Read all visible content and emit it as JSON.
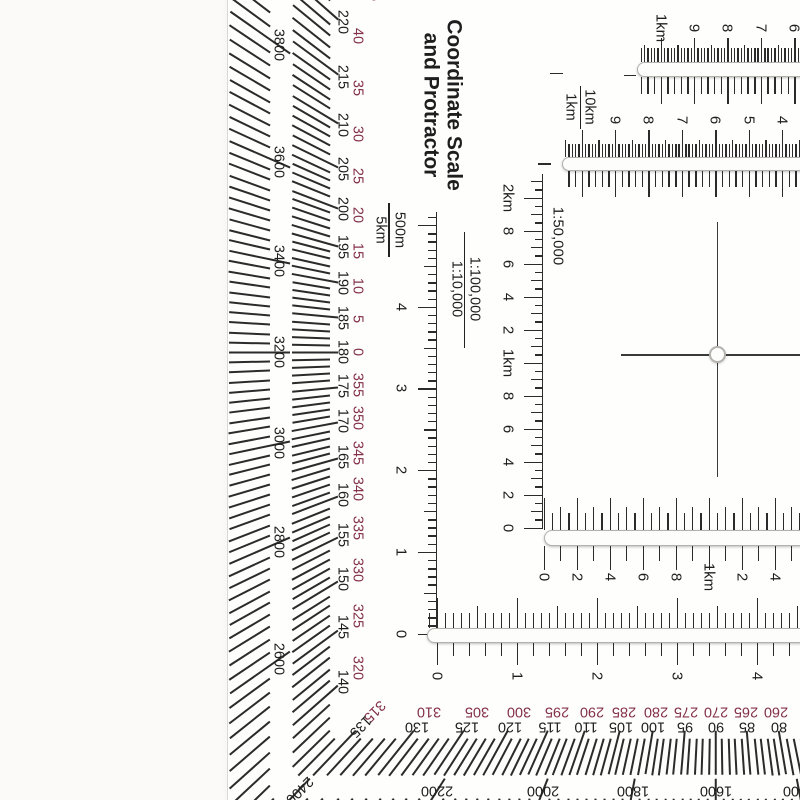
{
  "title": {
    "line1": "Coordinate Scale",
    "line2": "and Protractor"
  },
  "colors": {
    "ink": "#1e1e1e",
    "tick": "#2b2b2b",
    "red": "#84314a",
    "slot_border": "#b3b1ac",
    "slot_fill": "#fdfdfb",
    "background": "#fbfaf8",
    "tool_surface": "#fefefd",
    "edge": "#dbd8d3"
  },
  "labels": {
    "f500": {
      "left": "5km",
      "right": "500m"
    },
    "f1km": {
      "left": "1km",
      "right": "10km"
    },
    "f10k": {
      "left": "1:10,000",
      "right": "1:100,000"
    },
    "scale50k": "1:50,000"
  },
  "protractor": {
    "center": {
      "x": 716,
      "y": 352
    },
    "dy_stretch": 1.05,
    "deg": {
      "a_from": -104,
      "a_to": 48,
      "minor_inner": 386,
      "major_inner": 378,
      "outer": 424
    },
    "mils": {
      "step": 1.125,
      "i_from": -93,
      "i_to": 43,
      "minor_inner": 446,
      "major_inner": 426,
      "outer": 487
    },
    "red_dist": 359,
    "black_dist": 374,
    "mil_label_dist": 438,
    "deg_labels": [
      {
        "a": 45,
        "red": "45",
        "black": "225"
      },
      {
        "a": 40,
        "red": "40",
        "black": "220"
      },
      {
        "a": 35,
        "red": "35",
        "black": "215"
      },
      {
        "a": 30,
        "red": "30",
        "black": "210"
      },
      {
        "a": 25,
        "red": "25",
        "black": "205"
      },
      {
        "a": 20,
        "red": "20",
        "black": "200"
      },
      {
        "a": 15,
        "red": "15",
        "black": "195"
      },
      {
        "a": 10,
        "red": "10",
        "black": "190"
      },
      {
        "a": 5,
        "red": "5",
        "black": "185"
      },
      {
        "a": 0,
        "red": "0",
        "black": "180"
      },
      {
        "a": -5,
        "red": "355",
        "black": "175"
      },
      {
        "a": -10,
        "red": "350",
        "black": "170"
      },
      {
        "a": -15,
        "red": "345",
        "black": "165"
      },
      {
        "a": -20,
        "red": "340",
        "black": "160"
      },
      {
        "a": -25,
        "red": "335",
        "black": "155"
      },
      {
        "a": -30,
        "red": "330",
        "black": "150"
      },
      {
        "a": -35,
        "red": "325",
        "black": "145"
      },
      {
        "a": -40,
        "red": "320",
        "black": "140"
      },
      {
        "a": -45,
        "red": "315",
        "black": "135"
      },
      {
        "a": -50,
        "red": "310",
        "black": "130"
      },
      {
        "a": -55,
        "red": "305",
        "black": "125"
      },
      {
        "a": -60,
        "red": "300",
        "black": "120"
      },
      {
        "a": -65,
        "red": "295",
        "black": "115"
      },
      {
        "a": -70,
        "red": "290",
        "black": "110"
      },
      {
        "a": -75,
        "red": "285",
        "black": "105"
      },
      {
        "a": -80,
        "red": "280",
        "black": "100"
      },
      {
        "a": -85,
        "red": "275",
        "black": "95"
      },
      {
        "a": -90,
        "red": "270",
        "black": "90"
      },
      {
        "a": -95,
        "red": "265",
        "black": "85"
      },
      {
        "a": -100,
        "red": "260",
        "black": "80"
      }
    ],
    "mil_labels": [
      {
        "a": 33.75,
        "t": "3800"
      },
      {
        "a": 22.5,
        "t": "3600"
      },
      {
        "a": 11.25,
        "t": "3400"
      },
      {
        "a": 0,
        "t": "3200"
      },
      {
        "a": -11.25,
        "t": "3000"
      },
      {
        "a": -22.5,
        "t": "2800"
      },
      {
        "a": -33.75,
        "t": "2600"
      },
      {
        "a": -45,
        "t": "2400"
      },
      {
        "a": -56.25,
        "t": "2200"
      },
      {
        "a": -67.5,
        "t": "2000"
      },
      {
        "a": -78.75,
        "t": "1800"
      },
      {
        "a": -90,
        "t": "1600"
      },
      {
        "a": -101.25,
        "t": "1400"
      }
    ]
  },
  "crosshair": {
    "x": 716.5,
    "y": 354,
    "v_top": 222,
    "v_bottom": 477,
    "h_left": 621,
    "h_right": 803
  },
  "rulers": {
    "v10k": {
      "x": 435.5,
      "y_zero": 633.5,
      "ppu": 81.7,
      "minor": 0.1,
      "n": 51,
      "per_med": 5,
      "per_major": 10,
      "len_minor": 8,
      "len_med": 12,
      "len_major": 18,
      "line_top": 212,
      "label_x": 401,
      "labels": [
        {
          "u": 0,
          "t": "0"
        },
        {
          "u": 1,
          "t": "1"
        },
        {
          "u": 2,
          "t": "2"
        },
        {
          "u": 3,
          "t": "3"
        },
        {
          "u": 4,
          "t": "4"
        }
      ]
    },
    "v50k": {
      "x": 541.5,
      "y_zero": 527.5,
      "ppu": 16.5,
      "minor": 0.5,
      "n": 43,
      "per_med": 2,
      "per_major": 4,
      "len_minor": 7,
      "len_med": 11,
      "len_major": 18,
      "line_top": 174,
      "label_x": 508,
      "labels": [
        {
          "u": 20,
          "t": "2km"
        },
        {
          "u": 18,
          "t": "8"
        },
        {
          "u": 16,
          "t": "6"
        },
        {
          "u": 14,
          "t": "4"
        },
        {
          "u": 12,
          "t": "2"
        },
        {
          "u": 10,
          "t": "1km"
        },
        {
          "u": 8,
          "t": "8"
        },
        {
          "u": 6,
          "t": "6"
        },
        {
          "u": 4,
          "t": "4"
        },
        {
          "u": 2,
          "t": "2"
        },
        {
          "u": 0,
          "t": "0"
        }
      ]
    },
    "h50k": {
      "slot": {
        "x": 544,
        "y": 530,
        "w": 263,
        "h": 15.5
      },
      "x_zero": 543.5,
      "upx": 16.5,
      "label_y": 577,
      "above": {
        "px": 8.25,
        "i0": 0,
        "i1": 31,
        "per_med": 2,
        "per_major": 4,
        "len_minor": 17,
        "len_med": 23,
        "len_major": 32
      },
      "below": {
        "px": 16.5,
        "i0": 0,
        "i1": 15,
        "per_med": 2,
        "per_major": 2,
        "len_minor": 15,
        "len_med": 24,
        "len_major": 24
      },
      "labels": [
        {
          "u": 0,
          "t": "0"
        },
        {
          "u": 2,
          "t": "2"
        },
        {
          "u": 4,
          "t": "4"
        },
        {
          "u": 6,
          "t": "6"
        },
        {
          "u": 8,
          "t": "8"
        },
        {
          "u": 10,
          "t": "1km"
        },
        {
          "u": 12,
          "t": "2"
        },
        {
          "u": 14,
          "t": "4"
        },
        {
          "u": 16,
          "t": "6"
        }
      ]
    },
    "h10k": {
      "slot": {
        "x": 427,
        "y": 628,
        "w": 380,
        "h": 15
      },
      "x_zero": 437,
      "upx": 80,
      "label_y": 676,
      "above": {
        "px": 8,
        "i0": -1,
        "i1": 46,
        "per_med": 5,
        "per_major": 10,
        "len_minor": 15,
        "len_med": 22,
        "len_major": 30
      },
      "below": {
        "px": 16,
        "i0": 0,
        "i1": 23,
        "per_med": 5,
        "per_major": 5,
        "len_minor": 13,
        "len_med": 22,
        "len_major": 22
      },
      "labels": [
        {
          "u": 0,
          "t": "0"
        },
        {
          "u": 1,
          "t": "1"
        },
        {
          "u": 2,
          "t": "2"
        },
        {
          "u": 3,
          "t": "3"
        },
        {
          "u": 4,
          "t": "4"
        }
      ]
    },
    "t1": {
      "slot": {
        "x": 637,
        "y": 61.5,
        "w": 172,
        "h": 15
      },
      "x_zero": 660.6,
      "upx": 33.4,
      "label_y": 28,
      "above": {
        "px": 3.34,
        "i0": -6,
        "i1": 43,
        "per_med": 5,
        "per_major": 10,
        "len_minor": 13.5,
        "len_med": 17,
        "len_major": 24
      },
      "below": {
        "px": 6.68,
        "i0": -3,
        "i1": 21,
        "per_med": 5,
        "per_major": 5,
        "len_minor": 17,
        "len_med": 27,
        "len_major": 27
      },
      "labels": [
        {
          "u": 1,
          "t": "9"
        },
        {
          "u": 2,
          "t": "8"
        },
        {
          "u": 3,
          "t": "7"
        },
        {
          "u": 4,
          "t": "6"
        }
      ],
      "name_label": {
        "t": "1km",
        "x": 661,
        "y": 28
      },
      "dashes": [
        {
          "x": 624,
          "y": 74.5,
          "w": 12
        },
        {
          "x": 550,
          "y": 72.5,
          "w": 13
        }
      ]
    },
    "t2": {
      "slot": {
        "x": 562,
        "y": 157,
        "w": 246,
        "h": 13.5
      },
      "x_zero": 581.6,
      "upx": 33.4,
      "label_y": 120,
      "above": {
        "px": 3.34,
        "i0": -5,
        "i1": 67,
        "per_med": 5,
        "per_major": 10,
        "len_minor": 13,
        "len_med": 17,
        "len_major": 27
      },
      "below": {
        "px": 6.68,
        "i0": -2,
        "i1": 33,
        "per_med": 5,
        "per_major": 5,
        "len_minor": 16,
        "len_med": 26,
        "len_major": 26
      },
      "labels": [
        {
          "u": 1,
          "t": "9"
        },
        {
          "u": 2,
          "t": "8"
        },
        {
          "u": 3,
          "t": "7"
        },
        {
          "u": 4,
          "t": "6"
        },
        {
          "u": 5,
          "t": "5"
        },
        {
          "u": 6,
          "t": "4"
        }
      ],
      "dashes": [
        {
          "x": 538,
          "y": 163,
          "w": 13
        }
      ]
    }
  }
}
